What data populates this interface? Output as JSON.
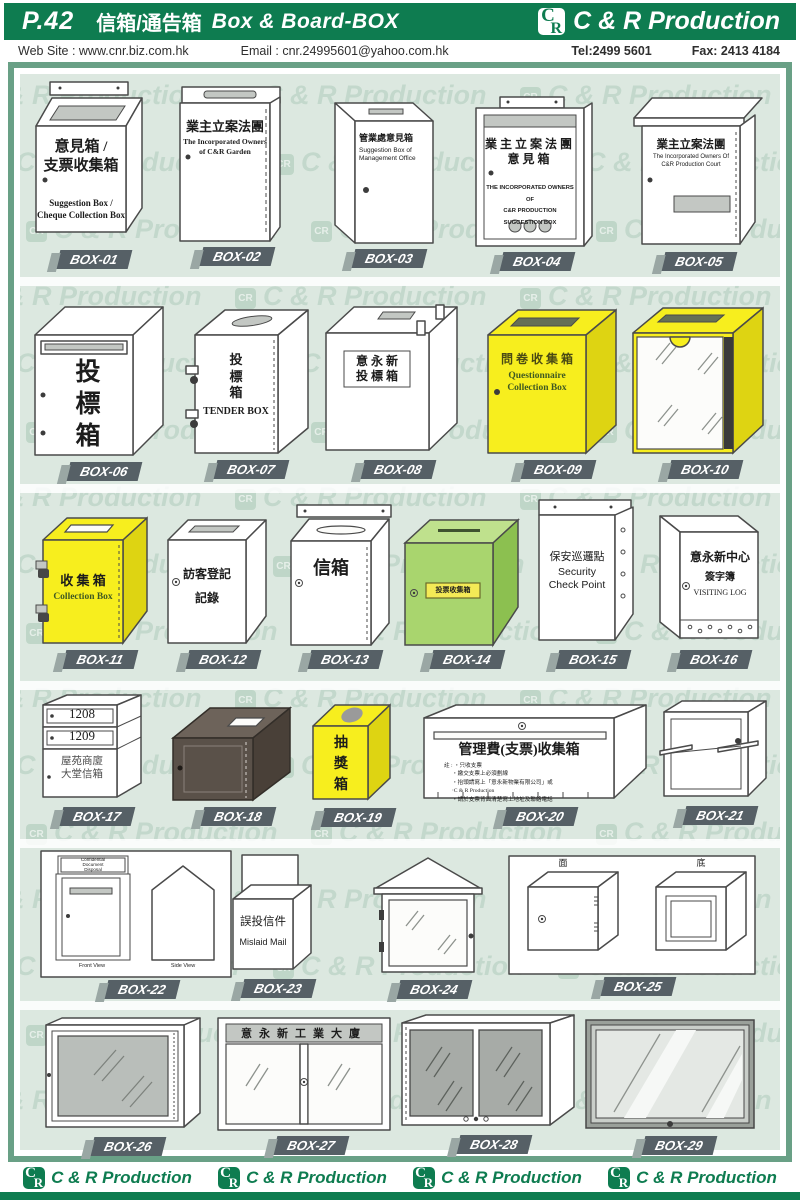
{
  "header": {
    "page": "P.42",
    "title_zh": "信箱/通告箱",
    "title_en": "Box & Board-BOX",
    "brand": "C & R Production",
    "logo_c": "C",
    "logo_r": "R"
  },
  "contact": {
    "website": "Web Site :  www.cnr.biz.com.hk",
    "email": "Email : cnr.24995601@yahoo.com.hk",
    "tel": "Tel:2499 5601",
    "fax": "Fax: 2413 4184"
  },
  "watermark": {
    "text": "C & R Production",
    "logo": "CR"
  },
  "footer": {
    "brand": "C & R Production"
  },
  "colors": {
    "header_green": "#0e7c50",
    "frame_green": "#69a086",
    "panel_sage": "#dce8e0",
    "accent_yellow": "#f7ee1e",
    "accent_green": "#a9d56e",
    "brown": "#5a5149",
    "tag_gray": "#566066"
  },
  "boxes": {
    "b01": {
      "id": "BOX-01",
      "zh": [
        "意見箱 /",
        "支票收集箱"
      ],
      "en": [
        "Suggestion Box /",
        "Cheque Collection Box"
      ]
    },
    "b02": {
      "id": "BOX-02",
      "zh": [
        "業主立案法團"
      ],
      "en": [
        "The Incorporated Owners",
        "of C&R Garden"
      ]
    },
    "b03": {
      "id": "BOX-03",
      "zh": [
        "管業處意見箱"
      ],
      "en": [
        "Suggestion Box of",
        "Management Office"
      ]
    },
    "b04": {
      "id": "BOX-04",
      "zh": [
        "業主立案法團",
        "意見箱"
      ],
      "en": [
        "THE INCORPORATED OWNERS OF",
        "C&R PRODUCTION",
        "SUGGESTION BOX"
      ]
    },
    "b05": {
      "id": "BOX-05",
      "zh": [
        "業主立案法團"
      ],
      "en": [
        "The Incorporated Owners Of",
        "C&R Production Court"
      ]
    },
    "b06": {
      "id": "BOX-06",
      "zh": [
        "投",
        "標",
        "箱"
      ]
    },
    "b07": {
      "id": "BOX-07",
      "zh": [
        "投",
        "標",
        "箱"
      ],
      "en": [
        "TENDER BOX"
      ]
    },
    "b08": {
      "id": "BOX-08",
      "zh": [
        "意 永 新",
        "投 標 箱"
      ]
    },
    "b09": {
      "id": "BOX-09",
      "zh": [
        "問 卷 收 集 箱"
      ],
      "en": [
        "Questionnaire",
        "Collection Box"
      ]
    },
    "b10": {
      "id": "BOX-10"
    },
    "b11": {
      "id": "BOX-11",
      "zh": [
        "收 集 箱"
      ],
      "en": [
        "Collection Box"
      ]
    },
    "b12": {
      "id": "BOX-12",
      "zh": [
        "訪客登記",
        "記錄"
      ]
    },
    "b13": {
      "id": "BOX-13",
      "zh": [
        "信箱"
      ]
    },
    "b14": {
      "id": "BOX-14",
      "zh": [
        "投票收集箱"
      ]
    },
    "b15": {
      "id": "BOX-15",
      "zh": [
        "保安巡邏點"
      ],
      "en": [
        "Security",
        "Check Point"
      ]
    },
    "b16": {
      "id": "BOX-16",
      "zh": [
        "意永新中心",
        "簽字簿"
      ],
      "en": [
        "VISITING LOG"
      ]
    },
    "b17": {
      "id": "BOX-17",
      "units": [
        "1208",
        "1209"
      ],
      "zh": [
        "屋苑商廈",
        "大堂信箱"
      ]
    },
    "b18": {
      "id": "BOX-18"
    },
    "b19": {
      "id": "BOX-19",
      "zh": [
        "抽",
        "獎",
        "箱"
      ]
    },
    "b20": {
      "id": "BOX-20",
      "title": "管理費(支票)收集箱",
      "notes": [
        "註 : ‧只收支票",
        "‧繳交支票上必須劃線",
        "‧抬頭請寫上「意永新物業有限公司」或",
        "‧C & R Production",
        "‧請於支票背面清楚寫上地址及聯絡電話"
      ]
    },
    "b21": {
      "id": "BOX-21"
    },
    "b22": {
      "id": "BOX-22",
      "header": [
        "Confidential",
        "Document",
        "Disposal"
      ],
      "captions": [
        "Front View",
        "Side View"
      ]
    },
    "b23": {
      "id": "BOX-23",
      "zh": [
        "誤投信件"
      ],
      "en": [
        "Mislaid Mail"
      ]
    },
    "b24": {
      "id": "BOX-24"
    },
    "b25": {
      "id": "BOX-25",
      "labels": [
        "面",
        "底"
      ]
    },
    "b26": {
      "id": "BOX-26"
    },
    "b27": {
      "id": "BOX-27",
      "zh": [
        "意永新工業大廈"
      ]
    },
    "b28": {
      "id": "BOX-28"
    },
    "b29": {
      "id": "BOX-29"
    }
  }
}
